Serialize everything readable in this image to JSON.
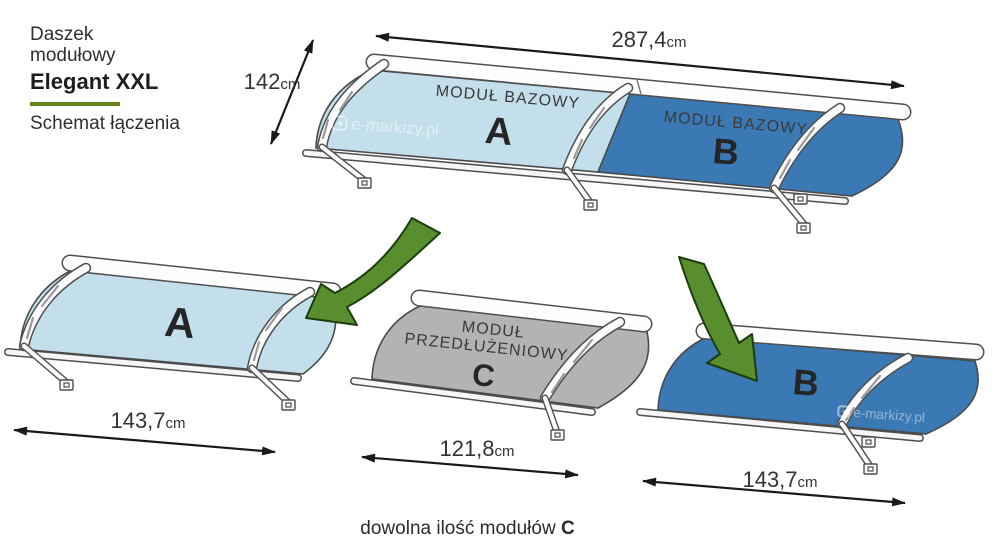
{
  "header": {
    "title_line1": "Daszek",
    "title_line2": "modułowy",
    "product_name": "Elegant XXL",
    "subtitle": "Schemat łączenia"
  },
  "assembly": {
    "total_width": {
      "value": "287,4",
      "unit": "cm"
    },
    "depth": {
      "value": "142",
      "unit": "cm"
    },
    "module_a_label": "MODUŁ BAZOWY",
    "module_a_letter": "A",
    "module_b_label": "MODUŁ BAZOWY",
    "module_b_letter": "B"
  },
  "module_a": {
    "letter": "A",
    "width": {
      "value": "143,7",
      "unit": "cm"
    }
  },
  "module_c": {
    "label_line1": "MODUŁ",
    "label_line2": "PRZEDŁUŻENIOWY",
    "letter": "C",
    "width": {
      "value": "121,8",
      "unit": "cm"
    }
  },
  "module_b": {
    "letter": "B",
    "width": {
      "value": "143,7",
      "unit": "cm"
    }
  },
  "caption": {
    "text": "dowolna ilość modułów ",
    "bold": "C"
  },
  "watermark": "e-markizy.pl",
  "colors": {
    "module_a_fill": "#c2dfeb",
    "module_b_fill": "#3a79b4",
    "module_c_fill": "#b3b3b2",
    "arrow_green": "#588e2d",
    "arrow_green_outline": "#1d3d0f",
    "accent_green": "#69861c",
    "outline": "#4f4f4f",
    "dimension_color": "#1a1a1a"
  }
}
